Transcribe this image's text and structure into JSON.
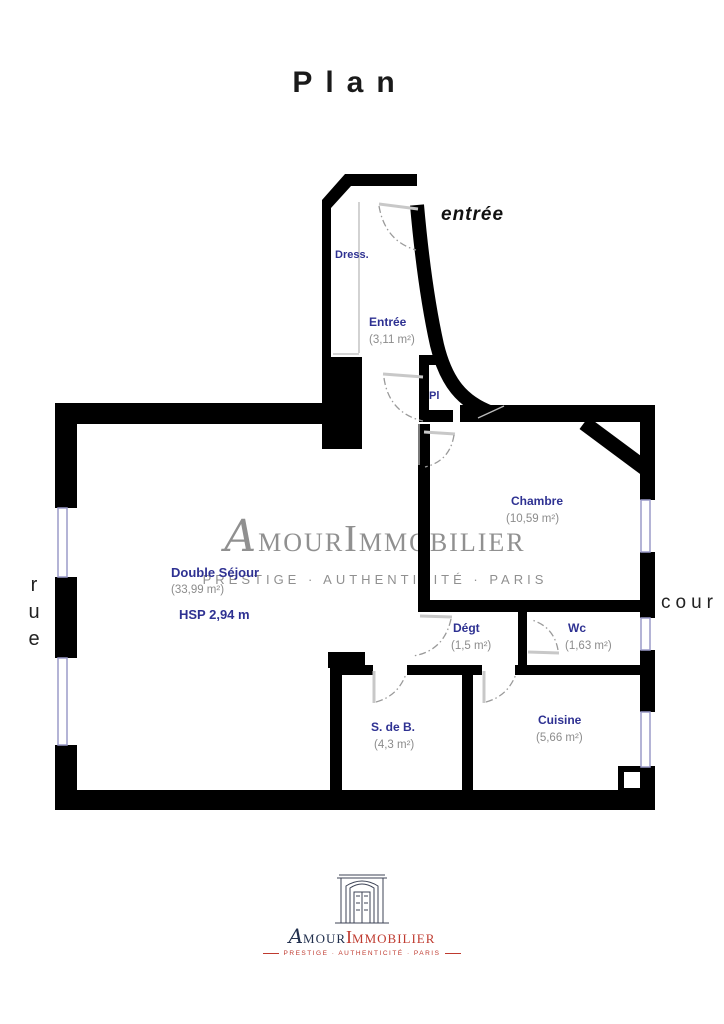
{
  "title": "Plan",
  "surroundings": {
    "entrance_label": "entrée",
    "street_label": "rue",
    "courtyard_label": "cour"
  },
  "rooms": {
    "dress": {
      "name": "Dress."
    },
    "entree": {
      "name": "Entrée",
      "area": "(3,11 m²)"
    },
    "placard": {
      "name": "Pl"
    },
    "chambre": {
      "name": "Chambre",
      "area": "(10,59 m²)"
    },
    "sejour": {
      "name": "Double Séjour",
      "area": "(33,99 m²)",
      "ceiling_height": "HSP 2,94 m"
    },
    "degagement": {
      "name": "Dégt",
      "area": "(1,5 m²)"
    },
    "wc": {
      "name": "Wc",
      "area": "(1,63 m²)"
    },
    "salle_de_bain": {
      "name": "S. de B.",
      "area": "(4,3 m²)"
    },
    "cuisine": {
      "name": "Cuisine",
      "area": "(5,66 m²)"
    }
  },
  "watermark": {
    "brand_initial_a": "A",
    "brand_amour_rest": "MOUR",
    "brand_initial_i": "I",
    "brand_immobilier_rest": "MMOBILIER",
    "tagline": "PRESTIGE · AUTHENTICITÉ · PARIS"
  },
  "footer": {
    "brand_initial_a": "A",
    "brand_amour_rest": "MOUR",
    "brand_initial_i": "I",
    "brand_immobilier_rest": "MMOBILIER",
    "tagline": "PRESTIGE · AUTHENTICITÉ · PARIS"
  },
  "colors": {
    "wall": "#000000",
    "room_label": "#2e3192",
    "area_label": "#8c8c8c",
    "window": "#9b9bc9",
    "watermark_gray": "#909090",
    "brand_navy": "#22304e",
    "brand_red": "#bf3a2f"
  }
}
